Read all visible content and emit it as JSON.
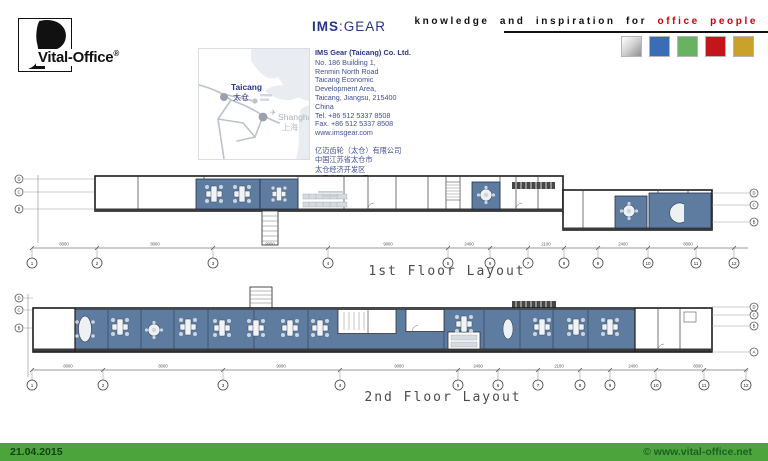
{
  "header": {
    "brand": {
      "text": "Vital-Office",
      "reg": "®"
    },
    "ims": {
      "bold": "IMS",
      "sep": ":",
      "rest": "GEAR",
      "company": "IMS Gear (Taicang) Co. Ltd.",
      "address_lines": [
        "No. 186 Building 1,",
        "Renmin North Road",
        "Taicang Economic",
        "Development Area,",
        "Taicang, Jiangsu, 215400",
        "China",
        "Tel. +86 512 5337 8508",
        "Fax. +86 512 5337 8508",
        "www.imsgear.com"
      ],
      "cn_lines": [
        "亿迈齿轮（太仓）有限公司",
        "中国江苏省太仓市",
        "太仓经济开发区",
        "人民北路186-1号",
        "邮编: 215400"
      ]
    },
    "map": {
      "taicang_en": "Taicang",
      "taicang_cn": "太仓",
      "shanghai_en": "Shanghai",
      "shanghai_cn": "上海",
      "plane": "✈"
    },
    "tagline": {
      "black": "knowledge and inspiration for",
      "red": "office people",
      "red_color": "#cc000a",
      "square_colors": [
        "silver-gradient",
        "#3a6db3",
        "#68b262",
        "#c2161b",
        "#c7a32b"
      ],
      "square_styles": [
        "background:linear-gradient(135deg,#ffffff 0%,#d6d6d6 45%,#8f8f8f 100%)",
        "background:#3a6db3",
        "background:#68b262",
        "background:#c2161b",
        "background:#c7a32b"
      ]
    }
  },
  "colors": {
    "plan_blue": "#5d7ca0",
    "wall": "#1c1c1c",
    "footer_green": "#4ca53c"
  },
  "plans": [
    {
      "label": "1st Floor Layout",
      "grid_numbers": [
        "1",
        "2",
        "3",
        "4",
        "5",
        "6",
        "7",
        "8",
        "9",
        "10",
        "11",
        "12"
      ],
      "left_letters": [
        "D",
        "C",
        "B"
      ],
      "right_letters": [
        "D",
        "C",
        "B"
      ],
      "dims": [
        "8000",
        "8000",
        "9000",
        "9000",
        "2400",
        "2100",
        "2400",
        "8000"
      ]
    },
    {
      "label": "2nd Floor Layout",
      "grid_numbers": [
        "1",
        "2",
        "3",
        "4",
        "5",
        "6",
        "7",
        "8",
        "9",
        "10",
        "11",
        "12"
      ],
      "left_letters": [
        "D",
        "C",
        "B"
      ],
      "right_letters": [
        "D",
        "C",
        "B",
        "A"
      ],
      "dims": [
        "8000",
        "8000",
        "9000",
        "9000",
        "2400",
        "2100",
        "2400",
        "8000"
      ]
    }
  ],
  "footer": {
    "date": "21.04.2015",
    "copyright": "© www.vital-office.net"
  }
}
